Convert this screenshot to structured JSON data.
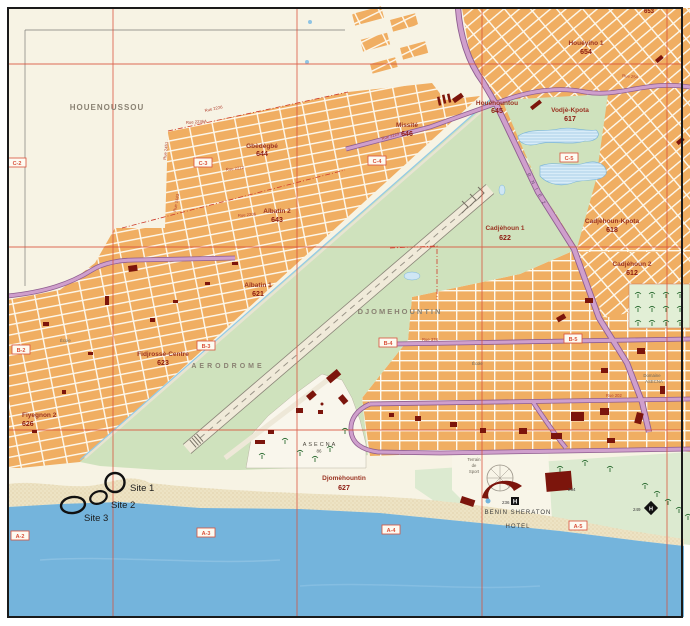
{
  "areas": {
    "houenoussou": "HOUENOUSSOU",
    "djomehountin_area": "DJOMEHOUNTIN",
    "aerodrome": "AERODROME",
    "asecna": "ASECNA",
    "asecna_num": "86",
    "domaine_line1": "Domaine",
    "domaine_line2": "ASECNA",
    "sheraton_line1": "BENIN SHERATON",
    "sheraton_line2": "HOTEL",
    "terrain_line1": "Terrain",
    "terrain_line2": "de",
    "terrain_line3": "Sport",
    "rnie2": "R N I E 2",
    "ecole": "École",
    "hotel_h": "H",
    "district_653": "653"
  },
  "districts": [
    {
      "name": "Gbèdègbé",
      "num": "644"
    },
    {
      "name": "Aïbatin 2",
      "num": "643"
    },
    {
      "name": "Missité",
      "num": "646"
    },
    {
      "name": "Houéhountou",
      "num": "645"
    },
    {
      "name": "Houéyiho 1",
      "num": "654"
    },
    {
      "name": "Vodjè-Kpota",
      "num": "617"
    },
    {
      "name": "Cadjèhoun 1",
      "num": "622"
    },
    {
      "name": "Cadjèhoun-Kpota",
      "num": "618"
    },
    {
      "name": "Cadjèhoun 2",
      "num": "612"
    },
    {
      "name": "Aïbatin 1",
      "num": "621"
    },
    {
      "name": "Fidjrossè-Centre",
      "num": "623"
    },
    {
      "name": "Fiyegnon 2",
      "num": "626"
    },
    {
      "name": "Djomèhountin",
      "num": "627"
    }
  ],
  "grid_cells": [
    "C-2",
    "C-3",
    "C-4",
    "C-5",
    "B-2",
    "B-3",
    "B-4",
    "B-5",
    "A-2",
    "A-3",
    "A-4",
    "A-5"
  ],
  "sites": [
    {
      "label": "Site 1"
    },
    {
      "label": "Site 2"
    },
    {
      "label": "Site 3"
    }
  ],
  "streets": [
    {
      "name": "Rue 2226"
    },
    {
      "name": "Rue 2236A"
    },
    {
      "name": "Rue 2451"
    },
    {
      "name": "Rue 2212"
    },
    {
      "name": "Rue 2443"
    },
    {
      "name": "Rue 2206"
    },
    {
      "name": "Rue 2229"
    },
    {
      "name": "Rue 378"
    },
    {
      "name": "Rue 202"
    },
    {
      "name": "Rue 254"
    }
  ],
  "building_numbers": {
    "sheraton_236": "236",
    "building_264": "264",
    "hotel_249": "249"
  },
  "colors": {
    "sea": "#74b4dc",
    "sand": "#ede3c4",
    "land": "#f7f3e4",
    "blocks_orange": "#f0ae62",
    "airport_green": "#cfe2bd",
    "coastal_green": "#dcead0",
    "lake_blue": "#d8ecf8",
    "road_purple": "#cf9fcc",
    "road_purple_edge": "#8f5e90",
    "grid_red": "#d9503a",
    "district_red": "#9a3322",
    "building_dark_red": "#7c150c",
    "site_annotation": "#111111"
  }
}
